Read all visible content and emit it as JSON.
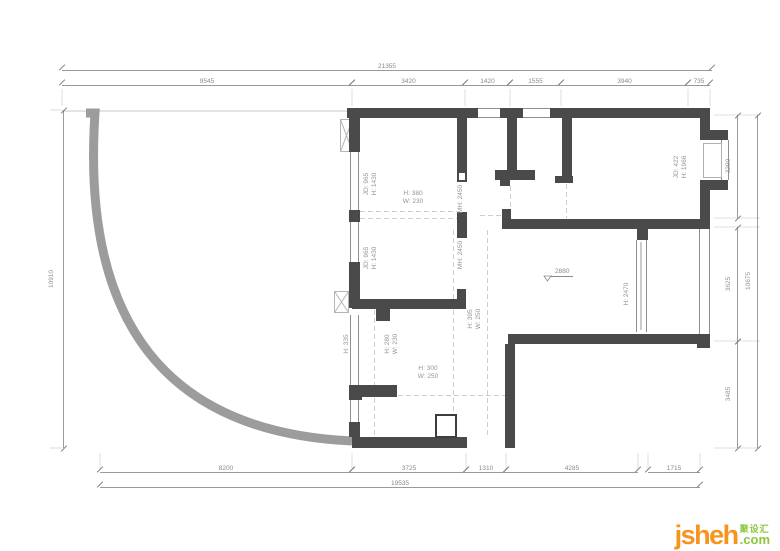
{
  "drawing": {
    "wall_color": "#4a4a4a",
    "curve_color": "#9c9c9c"
  },
  "dimensions": {
    "top_total": "21355",
    "top_segments": [
      "9545",
      "3420",
      "1420",
      "1555",
      "3940",
      "735"
    ],
    "left_total": "10910",
    "right_segments": [
      "3290",
      "3625",
      "3485"
    ],
    "right_total": "10675",
    "bottom_segments": [
      "8200",
      "3725",
      "1310",
      "4285"
    ],
    "bottom_right_segment": "1715",
    "bottom_total": "19535"
  },
  "annotations": {
    "door_left_upper": "JD: 965\nH: 1430",
    "door_left_lower": "JD: 965\nH: 1430",
    "cabinet_top": "H: 380\nW: 230",
    "opening_upper": "MH: 2450",
    "opening_lower": "MH: 2450",
    "cabinet_right": "H: 395\nW: 250",
    "cabinet_mid": "H: 280\nW: 230",
    "window_left": "H: 335",
    "cabinet_bottom": "H: 300\nW: 250",
    "level_value": "2880",
    "partition_height": "H: 2470",
    "bay_window": "JD: 422\nH: 1966"
  },
  "logo": {
    "name": "jsheh",
    "cn": "聚设汇",
    "tld": ".com"
  }
}
